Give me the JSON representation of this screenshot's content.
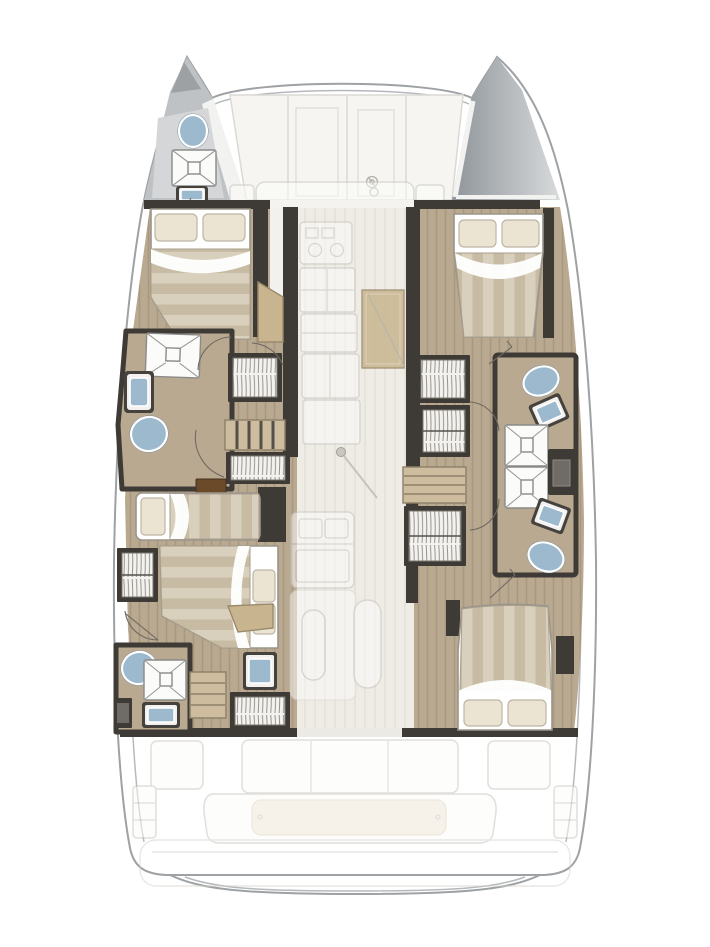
{
  "diagram": {
    "type": "yacht-floor-plan",
    "subject": "Catamaran accommodation and deck layout, top-down plan view, bow up",
    "visible_text": [],
    "decks": {
      "foredeck": {
        "features": [
          "hatch-panels",
          "windlass",
          "crossbeam",
          "port-bow-head",
          "starboard-bow-locker"
        ]
      },
      "salon_ghosted": {
        "features": [
          "galley-stove",
          "galley-counters",
          "entry-door",
          "mast-foot",
          "double-sink-unit",
          "table-benches",
          "forward-seating"
        ]
      },
      "cockpit_ghosted": {
        "features": [
          "three-seat-sofa",
          "side-seats",
          "aft-bench-with-cushion",
          "swim-platform",
          "transom-steps"
        ]
      }
    },
    "port_hull": {
      "rooms": [
        {
          "name": "bow-head",
          "fixtures": [
            "toilet",
            "shower",
            "sink"
          ]
        },
        {
          "name": "forward-cabin",
          "fixtures": [
            "double-bed",
            "bench"
          ]
        },
        {
          "name": "mid-bathroom",
          "fixtures": [
            "shower",
            "sink",
            "toilet"
          ]
        },
        {
          "name": "companionway",
          "fixtures": [
            "stairs",
            "wardrobe",
            "wardrobe",
            "step"
          ]
        },
        {
          "name": "mid-cabin",
          "fixtures": [
            "single-bed",
            "cabinet"
          ]
        },
        {
          "name": "aft-cabin",
          "fixtures": [
            "double-bed",
            "wardrobe",
            "side-table",
            "desk"
          ]
        },
        {
          "name": "aft-bathroom",
          "fixtures": [
            "toilet",
            "shower",
            "sink",
            "locker",
            "stairs",
            "vanity-sink",
            "wardrobe"
          ]
        }
      ]
    },
    "starboard_hull": {
      "rooms": [
        {
          "name": "bow-locker",
          "fixtures": []
        },
        {
          "name": "forward-cabin",
          "fixtures": [
            "double-bed"
          ]
        },
        {
          "name": "companionway",
          "fixtures": [
            "wardrobe",
            "wardrobe",
            "stairs",
            "wardrobe"
          ]
        },
        {
          "name": "forward-bathroom",
          "fixtures": [
            "toilet",
            "sink",
            "shower"
          ]
        },
        {
          "name": "aft-bathroom",
          "fixtures": [
            "shower",
            "sink",
            "toilet",
            "cabinet"
          ]
        },
        {
          "name": "aft-cabin",
          "fixtures": [
            "double-bed"
          ]
        }
      ]
    },
    "counts": {
      "double_beds": 4,
      "single_beds": 1,
      "bathrooms": 5,
      "showers": 5,
      "toilets": 5,
      "sinks": 7
    }
  },
  "palette": {
    "wall": "#3e3a36",
    "floor": "#b9a990",
    "stair": "#cdbc9e",
    "water": "#9db9cd",
    "pillow": "#ebe4d3",
    "duvetlight": "#d8cfbc",
    "duvetdark": "#c7bba3",
    "hullline": "#9ea2a5",
    "deckgray": "#bfc2c4",
    "ghostline": "#c6c3bd",
    "entrywood": "#c8b58f",
    "bedline": "#9a958c",
    "brownstep": "#6b4a2a",
    "cushion": "#efe8d8"
  }
}
